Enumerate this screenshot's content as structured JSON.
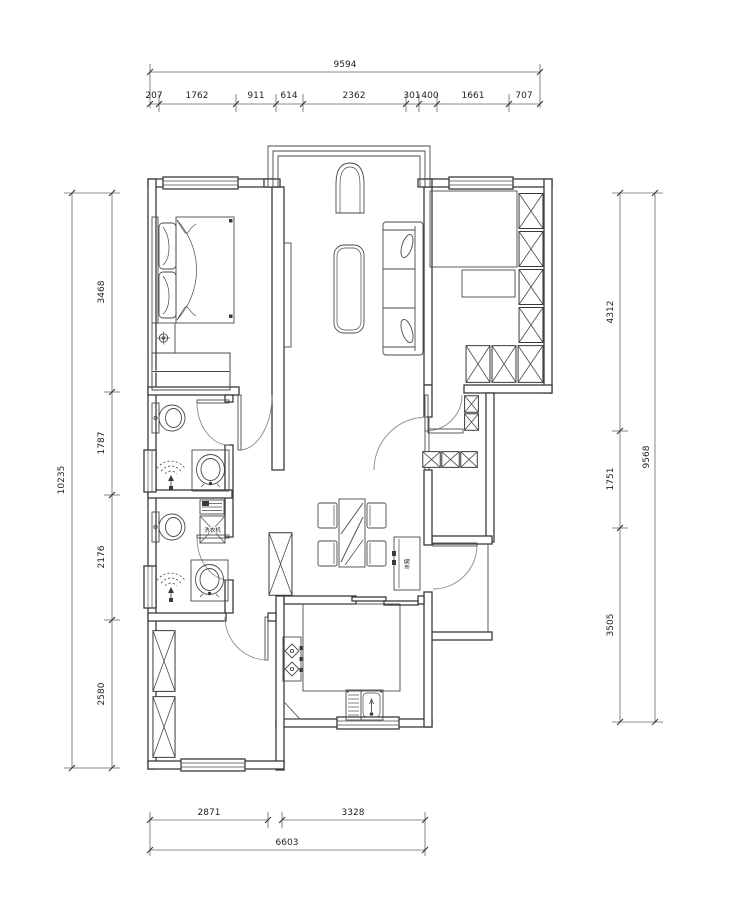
{
  "meta": {
    "type": "architectural-floor-plan",
    "units": "mm",
    "line_color": "#3a3a3a",
    "background": "#ffffff"
  },
  "dimensions": {
    "top": {
      "total": "9594",
      "segments": [
        "207",
        "1762",
        "911",
        "614",
        "2362",
        "301",
        "400",
        "1661",
        "707"
      ]
    },
    "left": {
      "total": "10235",
      "segments": [
        "3468",
        "1787",
        "2176",
        "2580"
      ]
    },
    "right": {
      "total": "9568",
      "segments": [
        "4312",
        "1751",
        "3505"
      ]
    },
    "bottom": {
      "total": "6603",
      "segments": [
        "2871",
        "3328"
      ]
    }
  },
  "labels": {
    "washing_machine": "洗衣机",
    "fridge": "冰箱"
  },
  "rooms": {
    "bedroom_1": [
      "bed",
      "pillows",
      "plant-stand",
      "hanging-wardrobe"
    ],
    "bathroom_1": [
      "toilet",
      "shower",
      "washbasin"
    ],
    "bathroom_2": [
      "toilet",
      "shower",
      "washbasin",
      "washing-machine"
    ],
    "bedroom_2": [
      "x-wardrobe"
    ],
    "living_room": [
      "arched-console",
      "coffee-table",
      "sofa",
      "tv-board",
      "bay-window"
    ],
    "study": [
      "desk",
      "x-wardrobe"
    ],
    "dining": [
      "dining-table",
      "four-chairs",
      "refrigerator",
      "storage-cabinet"
    ],
    "kitchen": [
      "counter",
      "gas-stove",
      "sink",
      "corner-shelf"
    ],
    "foyer": [
      "shoe-cabinets",
      "entry-door"
    ]
  }
}
